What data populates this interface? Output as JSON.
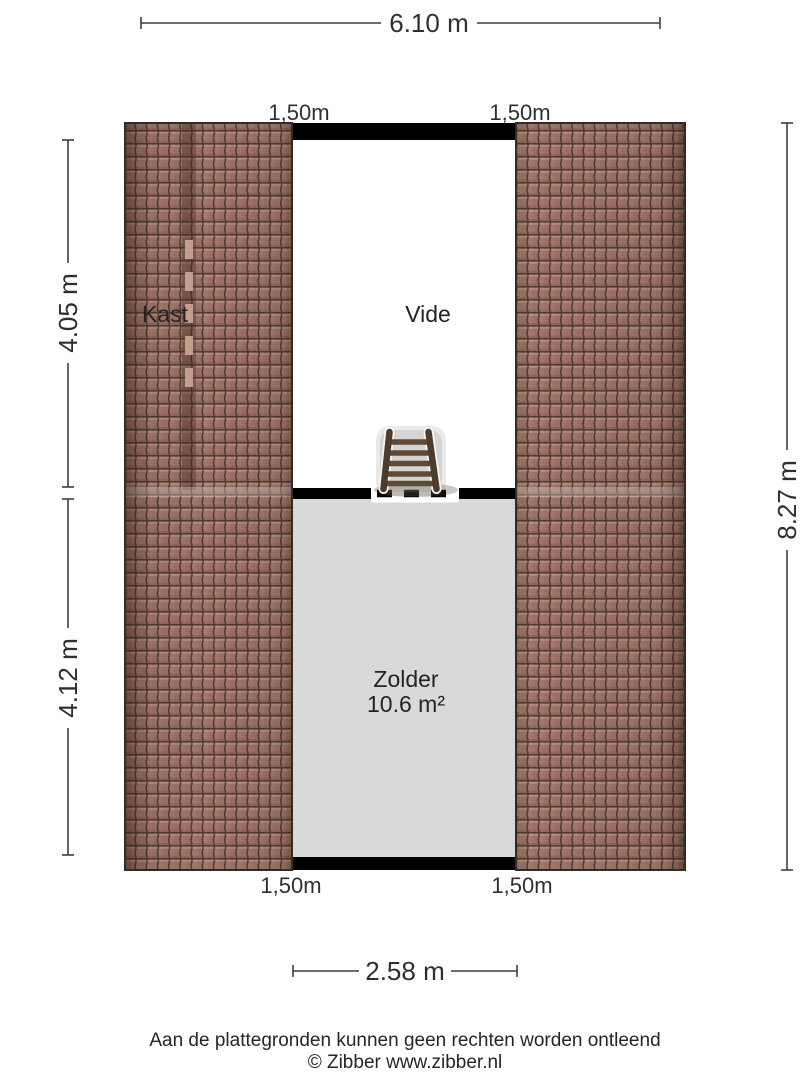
{
  "plan": {
    "rooms": {
      "kast": {
        "label": "Kast"
      },
      "vide": {
        "label": "Vide"
      },
      "zolder": {
        "label": "Zolder",
        "area": "10.6 m²"
      }
    },
    "dimensions": {
      "width_total": "6.10 m",
      "left_upper": "4.05 m",
      "left_lower": "4.12 m",
      "height_total": "8.27 m",
      "bottom_width": "2.58 m",
      "headroom": {
        "top_left": "1,50m",
        "top_right": "1,50m",
        "bottom_left": "1,50m",
        "bottom_right": "1,50m"
      }
    }
  },
  "icons": {
    "ladder": "loft-ladder"
  },
  "footer": {
    "disclaimer": "Aan de plattegronden kunnen geen rechten worden ontleend",
    "copyright": "© Zibber www.zibber.nl"
  },
  "colors": {
    "roof_tile": "#a2766a",
    "roof_tile_dark": "#4a3b31",
    "roof_tile_highlight": "#b98e7e",
    "floor": "#d9d9d9",
    "vide_floor": "#ffffff",
    "wall": "#000000",
    "dimension_line": "#3f3f3f",
    "ladder_rail": "#4c3c2d",
    "ladder_rung": "#5e4937"
  }
}
